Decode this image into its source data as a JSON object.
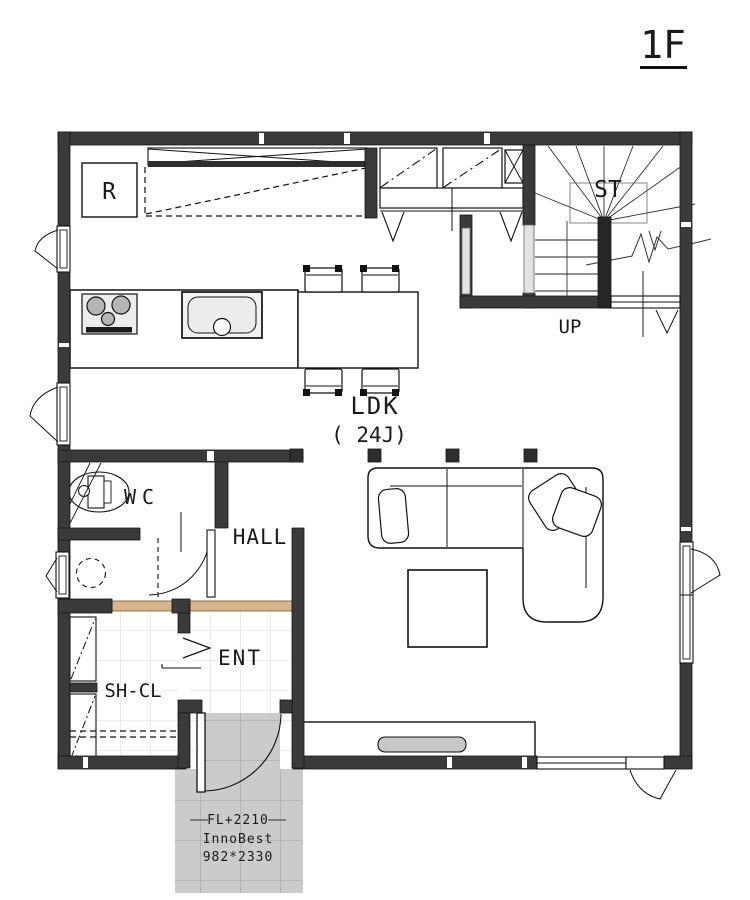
{
  "floor": {
    "label": "1F"
  },
  "rooms": {
    "stairs": {
      "label": "ST",
      "direction_label": "UP"
    },
    "living_dining_kitchen": {
      "label": "LDK",
      "size_label": "( 24J)"
    },
    "toilet": {
      "label": "WC"
    },
    "hall": {
      "label": "HALL"
    },
    "entrance": {
      "label": "ENT"
    },
    "shoe_closet": {
      "label": "SH-CL"
    }
  },
  "appliances": {
    "refrigerator_label": "R"
  },
  "entrance_door": {
    "floor_level": "FL+2210",
    "product": "InnoBest",
    "size": "982*2330"
  },
  "colors": {
    "wall": "#3a3a3a",
    "entry_step": "#d7b68d",
    "porch_tile": "#cbcbcb",
    "ink": "#1a1a1a"
  }
}
